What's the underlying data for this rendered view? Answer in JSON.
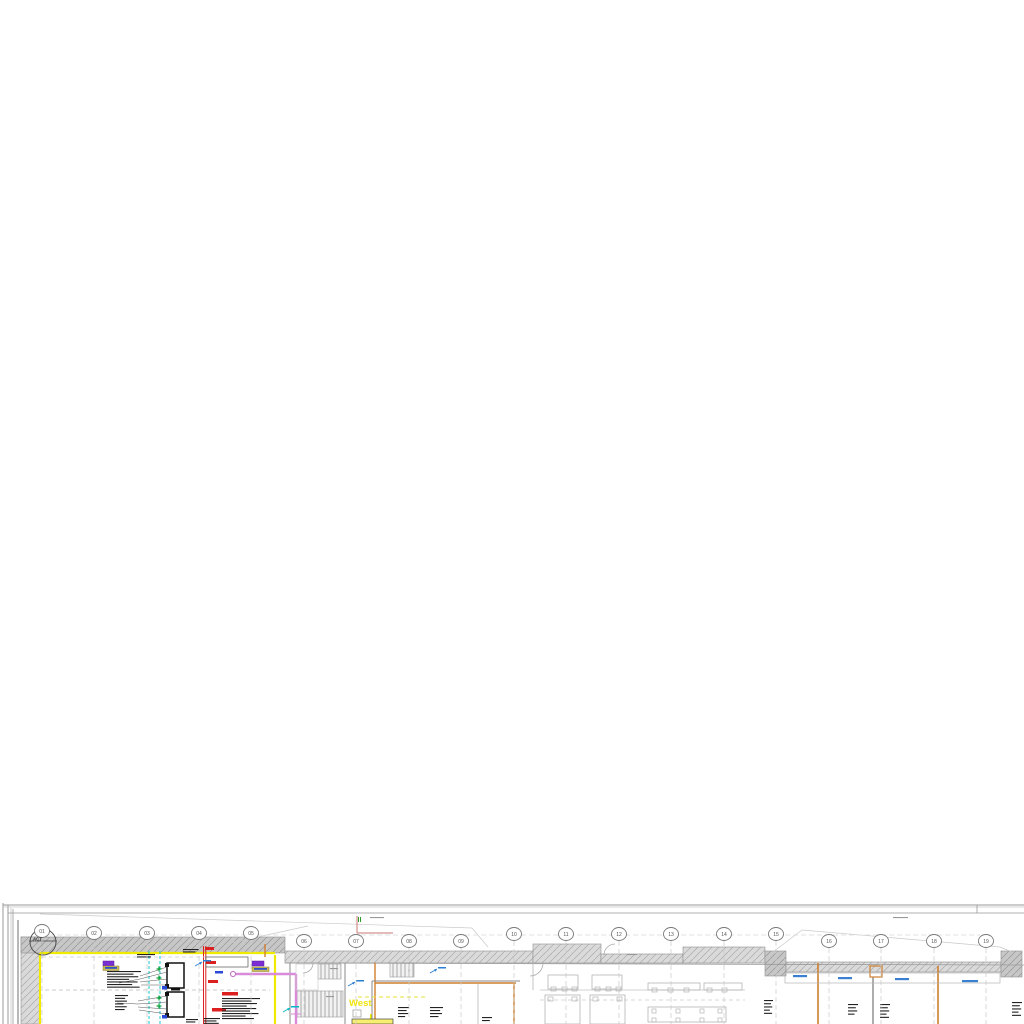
{
  "texts": {
    "act": "ACT",
    "west": "West"
  },
  "grid_bubbles": [
    {
      "label": "01",
      "x": 42,
      "y": 931
    },
    {
      "label": "02",
      "x": 94,
      "y": 933
    },
    {
      "label": "03",
      "x": 147,
      "y": 933
    },
    {
      "label": "04",
      "x": 199,
      "y": 933
    },
    {
      "label": "05",
      "x": 251,
      "y": 933
    },
    {
      "label": "06",
      "x": 304,
      "y": 941
    },
    {
      "label": "07",
      "x": 356,
      "y": 941
    },
    {
      "label": "08",
      "x": 409,
      "y": 941
    },
    {
      "label": "09",
      "x": 461,
      "y": 941
    },
    {
      "label": "10",
      "x": 514,
      "y": 934
    },
    {
      "label": "11",
      "x": 566,
      "y": 934
    },
    {
      "label": "12",
      "x": 619,
      "y": 934
    },
    {
      "label": "13",
      "x": 671,
      "y": 934
    },
    {
      "label": "14",
      "x": 724,
      "y": 934
    },
    {
      "label": "15",
      "x": 776,
      "y": 934
    },
    {
      "label": "16",
      "x": 829,
      "y": 941
    },
    {
      "label": "17",
      "x": 881,
      "y": 941
    },
    {
      "label": "18",
      "x": 934,
      "y": 941
    },
    {
      "label": "19",
      "x": 986,
      "y": 941
    }
  ],
  "primitives": {
    "hatch_rects": [
      [
        21,
        937,
        19,
        87,
        "hl"
      ],
      [
        21,
        937,
        264,
        16,
        "hd"
      ],
      [
        285,
        951,
        248,
        12,
        "hl"
      ],
      [
        533,
        944,
        68,
        19,
        "hl"
      ],
      [
        601,
        954,
        82,
        9,
        "hl"
      ],
      [
        683,
        947,
        82,
        16,
        "hl"
      ],
      [
        765,
        951,
        21,
        25,
        "hd"
      ],
      [
        786,
        962,
        215,
        10,
        "hl"
      ],
      [
        1001,
        951,
        21,
        26,
        "hd"
      ]
    ],
    "stripe_rects": [
      [
        318,
        964,
        23,
        15
      ],
      [
        296,
        991,
        47,
        26
      ],
      [
        390,
        963,
        24,
        14
      ]
    ],
    "lines": [
      [
        3,
        903,
        3,
        1024,
        "#999",
        1
      ],
      [
        8,
        905,
        8,
        1024,
        "#999",
        1
      ],
      [
        11,
        908,
        11,
        1024,
        "#c5c5c5",
        0.8
      ],
      [
        13,
        909,
        13,
        1024,
        "#999",
        0.8
      ],
      [
        18,
        920,
        18,
        1024,
        "#888",
        1.2
      ],
      [
        3,
        905,
        1024,
        905,
        "#999",
        1
      ],
      [
        3,
        907,
        1024,
        907,
        "#c5c5c5",
        0.8
      ],
      [
        8,
        913,
        1024,
        913,
        "#999",
        0.8
      ],
      [
        977,
        905,
        977,
        913,
        "#999",
        0.8
      ],
      [
        40,
        914,
        472,
        928,
        "#c9c9c9",
        0.7
      ],
      [
        472,
        928,
        488,
        947,
        "#c9c9c9",
        0.7
      ],
      [
        230,
        943,
        308,
        926,
        "#c9c9c9",
        0.7
      ],
      [
        765,
        958,
        802,
        930,
        "#c9c9c9",
        0.7
      ],
      [
        802,
        930,
        1000,
        947,
        "#c9c9c9",
        0.7
      ],
      [
        1000,
        947,
        1012,
        952,
        "#c9c9c9",
        0.7
      ],
      [
        285,
        963,
        1024,
        965,
        "#9a9a9a",
        0.8
      ],
      [
        40,
        953,
        275,
        953,
        "#f0ea00",
        2.2
      ],
      [
        40,
        953,
        40,
        1024,
        "#f0ea00",
        2.2
      ],
      [
        275,
        955,
        275,
        1024,
        "#f0ea00",
        2.2
      ],
      [
        371,
        1014,
        371,
        1024,
        "#f0ea00",
        2
      ],
      [
        265,
        944,
        265,
        957,
        "#cf7f2e",
        1.4
      ],
      [
        375,
        963,
        375,
        1024,
        "#cf7f2e",
        1.4
      ],
      [
        375,
        983,
        516,
        983,
        "#cf7f2e",
        1.4
      ],
      [
        514,
        983,
        514,
        1024,
        "#cf7f2e",
        1.4
      ],
      [
        818,
        963,
        818,
        1024,
        "#cf7f2e",
        1.6
      ],
      [
        938,
        966,
        938,
        1024,
        "#cf7f2e",
        1.6
      ],
      [
        290,
        963,
        290,
        1024,
        "#8a8a8a",
        1
      ],
      [
        345,
        963,
        345,
        1024,
        "#8a8a8a",
        1
      ],
      [
        372,
        981,
        372,
        1024,
        "#8a8a8a",
        1
      ],
      [
        372,
        981,
        520,
        981,
        "#8a8a8a",
        1
      ],
      [
        478,
        984,
        478,
        1024,
        "#b5b5b5",
        0.8
      ],
      [
        533,
        963,
        533,
        990,
        "#b5b5b5",
        0.8
      ],
      [
        873,
        977,
        873,
        1024,
        "#8a8a8a",
        1.4
      ],
      [
        540,
        990,
        745,
        990,
        "#c0c0c0",
        0.7
      ],
      [
        203.5,
        946,
        203.5,
        1024,
        "#dc1f1f",
        1
      ],
      [
        205.8,
        946,
        205.8,
        1024,
        "#dc1f1f",
        1
      ],
      [
        357,
        916,
        357,
        933,
        "#cc7777",
        1
      ],
      [
        357,
        933,
        393,
        933,
        "#cc7777",
        1
      ],
      [
        358.5,
        917,
        358.5,
        922,
        "#2aa02a",
        1
      ],
      [
        360.5,
        917,
        360.5,
        922,
        "#2aa02a",
        1
      ],
      [
        236,
        974,
        296,
        974,
        "#d98bd9",
        2.4
      ],
      [
        296,
        974,
        296,
        1024,
        "#d98bd9",
        2.4
      ],
      [
        291,
        1014,
        301,
        1014,
        "#d98bd9",
        1
      ],
      [
        167,
        968,
        184,
        968,
        "#111",
        0.8
      ],
      [
        167,
        983,
        184,
        983,
        "#111",
        0.8
      ],
      [
        167,
        997,
        184,
        997,
        "#111",
        0.8
      ],
      [
        167,
        1012,
        184,
        1012,
        "#111",
        0.8
      ],
      [
        29,
        941,
        57,
        941,
        "#444",
        0.8
      ],
      [
        42,
        926,
        42,
        958,
        "#999",
        0.6
      ]
    ],
    "dashed_lines": [
      [
        49,
        935,
        980,
        935,
        "#d8d8d8",
        0.7,
        "5 3"
      ],
      [
        45,
        990,
        270,
        990,
        "#bbbbbb",
        0.8,
        "4 3"
      ],
      [
        42,
        957,
        205,
        957,
        "#cccccc",
        0.7,
        "4 3"
      ],
      [
        149,
        951,
        149,
        1024,
        "#00c5cd",
        0.9,
        "3 2"
      ],
      [
        160,
        951,
        160,
        1024,
        "#00c5cd",
        0.9,
        "3 2"
      ],
      [
        358,
        997,
        428,
        997,
        "#e8e032",
        1,
        "4 3"
      ],
      [
        540,
        1000,
        745,
        1000,
        "#cccccc",
        0.7,
        "4 3"
      ]
    ],
    "rects": [
      [
        206,
        957,
        42,
        10,
        "#ffffff",
        "#555555",
        0.7
      ],
      [
        103,
        961,
        11,
        5,
        "#7b2fd2",
        "#5a1fa0",
        0.5
      ],
      [
        252,
        961,
        12,
        5,
        "#7b2fd2",
        "#5a1fa0",
        0.5
      ],
      [
        103,
        966,
        16,
        4.5,
        "#cdbc58",
        "#8a7d2a",
        0.5
      ],
      [
        252,
        967,
        17,
        4.5,
        "#cdbc58",
        "#8a7d2a",
        0.5
      ],
      [
        167,
        963,
        17,
        25,
        "#ffffff",
        "#111111",
        1.5
      ],
      [
        167,
        992,
        17,
        25,
        "#ffffff",
        "#111111",
        1.5
      ],
      [
        165,
        963,
        4,
        4,
        "#111111",
        "none",
        0
      ],
      [
        165,
        984,
        4,
        4,
        "#111111",
        "none",
        0
      ],
      [
        165,
        992,
        4,
        4,
        "#111111",
        "none",
        0
      ],
      [
        165,
        1013,
        4,
        4,
        "#111111",
        "none",
        0
      ],
      [
        162,
        986,
        5,
        3.5,
        "#2b49d8",
        "none",
        0
      ],
      [
        162,
        1015,
        5,
        3.5,
        "#2b49d8",
        "none",
        0
      ],
      [
        171,
        988.5,
        9,
        2,
        "#111111",
        "none",
        0
      ],
      [
        870,
        966,
        12,
        11,
        "none",
        "#cf7f2e",
        1.2
      ],
      [
        785,
        973,
        215,
        10,
        "none",
        "#b5b5b5",
        0.7
      ],
      [
        296,
        964,
        22,
        26,
        "none",
        "#cccccc",
        0.7
      ],
      [
        548,
        975,
        30,
        14,
        "none",
        "#b5b5b5",
        0.8
      ],
      [
        592,
        975,
        30,
        14,
        "none",
        "#b5b5b5",
        0.8
      ],
      [
        551,
        987,
        5,
        4,
        "none",
        "#b5b5b5",
        0.7
      ],
      [
        562,
        987,
        5,
        4,
        "none",
        "#b5b5b5",
        0.7
      ],
      [
        572,
        987,
        5,
        4,
        "none",
        "#b5b5b5",
        0.7
      ],
      [
        595,
        987,
        5,
        4,
        "none",
        "#b5b5b5",
        0.7
      ],
      [
        606,
        987,
        5,
        4,
        "none",
        "#b5b5b5",
        0.7
      ],
      [
        616,
        987,
        5,
        4,
        "none",
        "#b5b5b5",
        0.7
      ],
      [
        648,
        983,
        52,
        7,
        "none",
        "#b5b5b5",
        0.8
      ],
      [
        704,
        983,
        38,
        7,
        "none",
        "#b5b5b5",
        0.8
      ],
      [
        652,
        988,
        5,
        4,
        "none",
        "#b5b5b5",
        0.7
      ],
      [
        668,
        988,
        5,
        4,
        "none",
        "#b5b5b5",
        0.7
      ],
      [
        684,
        988,
        5,
        4,
        "none",
        "#b5b5b5",
        0.7
      ],
      [
        707,
        988,
        5,
        4,
        "none",
        "#b5b5b5",
        0.7
      ],
      [
        722,
        988,
        5,
        4,
        "none",
        "#b5b5b5",
        0.7
      ],
      [
        545,
        995,
        35,
        29,
        "none",
        "#b5b5b5",
        0.8
      ],
      [
        590,
        995,
        35,
        29,
        "none",
        "#b5b5b5",
        0.8
      ],
      [
        548,
        997,
        5,
        4,
        "none",
        "#b5b5b5",
        0.7
      ],
      [
        572,
        997,
        5,
        4,
        "none",
        "#b5b5b5",
        0.7
      ],
      [
        593,
        997,
        5,
        4,
        "none",
        "#b5b5b5",
        0.7
      ],
      [
        617,
        997,
        5,
        4,
        "none",
        "#b5b5b5",
        0.7
      ],
      [
        648,
        1007,
        78,
        15,
        "none",
        "#b5b5b5",
        0.8
      ],
      [
        652,
        1009,
        4,
        4,
        "none",
        "#b5b5b5",
        0.7
      ],
      [
        676,
        1009,
        4,
        4,
        "none",
        "#b5b5b5",
        0.7
      ],
      [
        700,
        1009,
        4,
        4,
        "none",
        "#b5b5b5",
        0.7
      ],
      [
        718,
        1009,
        4,
        4,
        "none",
        "#b5b5b5",
        0.7
      ],
      [
        652,
        1018,
        4,
        4,
        "none",
        "#b5b5b5",
        0.7
      ],
      [
        676,
        1018,
        4,
        4,
        "none",
        "#b5b5b5",
        0.7
      ],
      [
        700,
        1018,
        4,
        4,
        "none",
        "#b5b5b5",
        0.7
      ],
      [
        718,
        1018,
        4,
        4,
        "none",
        "#b5b5b5",
        0.7
      ],
      [
        352,
        1019,
        41,
        5,
        "#f7ef70",
        "#444444",
        0.7
      ],
      [
        353,
        1010,
        8,
        7,
        "none",
        "#999999",
        0.7
      ]
    ],
    "circles": [
      [
        43,
        942,
        13,
        "none",
        "#444444",
        0.9
      ],
      [
        233,
        974,
        2.5,
        "#ffffff",
        "#c060c0",
        1
      ]
    ],
    "arcs": [
      [
        "M530,976 A13,13 0 0 0 543,963",
        "#aaaaaa",
        0.8
      ],
      [
        "M604,955 A11,11 0 0 1 615,944",
        "#aaaaaa",
        0.8
      ],
      [
        "M313,963 A10,10 0 0 1 303,973",
        "#aaaaaa",
        0.8
      ]
    ],
    "micro_text_blocks": [
      [
        107,
        971,
        34,
        7,
        2.6,
        "#222222"
      ],
      [
        115,
        995,
        13,
        6,
        2.8,
        "#222222"
      ],
      [
        222,
        998,
        38,
        9,
        2.5,
        "#222222"
      ],
      [
        204,
        1018,
        16,
        3,
        2.4,
        "#222222"
      ],
      [
        137,
        954,
        18,
        2,
        2.4,
        "#222222"
      ],
      [
        183,
        949,
        16,
        2,
        2.4,
        "#222222"
      ],
      [
        186,
        1019,
        12,
        2,
        2.4,
        "#222222"
      ],
      [
        398,
        1007,
        11,
        4,
        3,
        "#222222"
      ],
      [
        430,
        1007,
        13,
        4,
        3,
        "#222222"
      ],
      [
        482,
        1017,
        10,
        2,
        3,
        "#222222"
      ],
      [
        764,
        1000,
        9,
        5,
        3.2,
        "#222222"
      ],
      [
        848,
        1004,
        10,
        4,
        3.2,
        "#222222"
      ],
      [
        880,
        1004,
        10,
        5,
        3.2,
        "#222222"
      ],
      [
        1012,
        1002,
        10,
        5,
        3.2,
        "#222222"
      ],
      [
        370,
        917,
        14,
        1,
        2,
        "#999999"
      ],
      [
        893,
        917,
        15,
        1,
        2,
        "#999999"
      ],
      [
        627,
        954,
        10,
        1,
        2,
        "#999999"
      ],
      [
        330,
        968,
        8,
        1,
        2,
        "#999999"
      ],
      [
        326,
        996,
        8,
        1,
        2,
        "#999999"
      ]
    ],
    "color_dashes": [
      [
        205,
        947,
        9,
        3,
        "#dc1f1f"
      ],
      [
        206,
        961,
        10,
        3,
        "#dc1f1f"
      ],
      [
        208,
        980,
        10,
        3,
        "#dc1f1f"
      ],
      [
        222,
        992,
        16,
        3.5,
        "#dc1f1f"
      ],
      [
        212,
        1008,
        14,
        3.5,
        "#dc1f1f"
      ],
      [
        215,
        971,
        8,
        2.5,
        "#2b49d8"
      ],
      [
        105,
        967,
        12,
        1.8,
        "#2d53c9"
      ],
      [
        254,
        968,
        13,
        1.8,
        "#2d53c9"
      ],
      [
        793,
        975,
        14,
        2.2,
        "#3b7fd0"
      ],
      [
        838,
        977,
        14,
        2.2,
        "#3b7fd0"
      ],
      [
        895,
        978,
        14,
        2.2,
        "#3b7fd0"
      ],
      [
        962,
        980,
        16,
        2.2,
        "#3b7fd0"
      ]
    ],
    "plus_marks": [
      [
        159,
        969,
        "#0c9f30"
      ],
      [
        159,
        978,
        "#0c9f30"
      ],
      [
        159,
        998,
        "#0c9f30"
      ],
      [
        159,
        1006,
        "#0c9f30"
      ]
    ],
    "flow_arrows": [
      [
        195,
        963,
        "#2a7fd4"
      ],
      [
        348,
        983,
        "#2a7fd4"
      ],
      [
        430,
        970,
        "#2a7fd4"
      ],
      [
        283,
        1009,
        "#00b8c8"
      ]
    ],
    "leader_lines": [
      [
        140,
        976,
        167,
        967
      ],
      [
        140,
        979,
        167,
        972
      ],
      [
        140,
        982,
        167,
        979
      ],
      [
        141,
        985,
        167,
        985
      ],
      [
        138,
        1001,
        167,
        996
      ],
      [
        138,
        1004,
        167,
        1002
      ],
      [
        138,
        1007,
        167,
        1009
      ],
      [
        139,
        1010,
        167,
        1014
      ],
      [
        119,
        983,
        140,
        979
      ],
      [
        117,
        1003,
        138,
        1004
      ]
    ]
  }
}
